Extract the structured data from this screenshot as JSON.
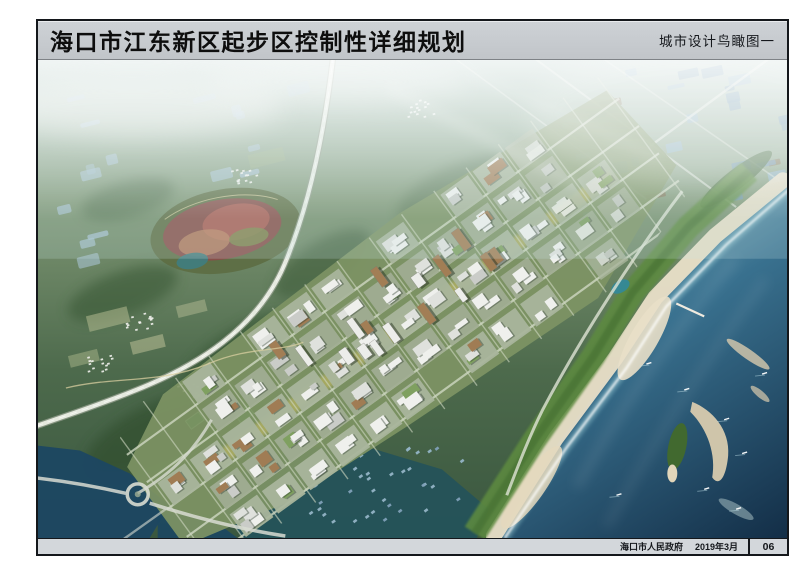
{
  "document": {
    "header": {
      "title": "海口市江东新区起步区控制性详细规划",
      "sheet_label": "城市设计鸟瞰图一"
    },
    "footer": {
      "publisher": "海口市人民政府",
      "date": "2019年3月",
      "page_number": "06"
    },
    "colors": {
      "header_bg": "#c9cdd1",
      "footer_bg": "#d3d7db",
      "frame_border": "#14171b",
      "ocean_deep": "#15334e",
      "ocean_shallow": "#7db0bf",
      "beach_sand": "#e9dfc8",
      "land_green": "#4d6a4c"
    }
  }
}
